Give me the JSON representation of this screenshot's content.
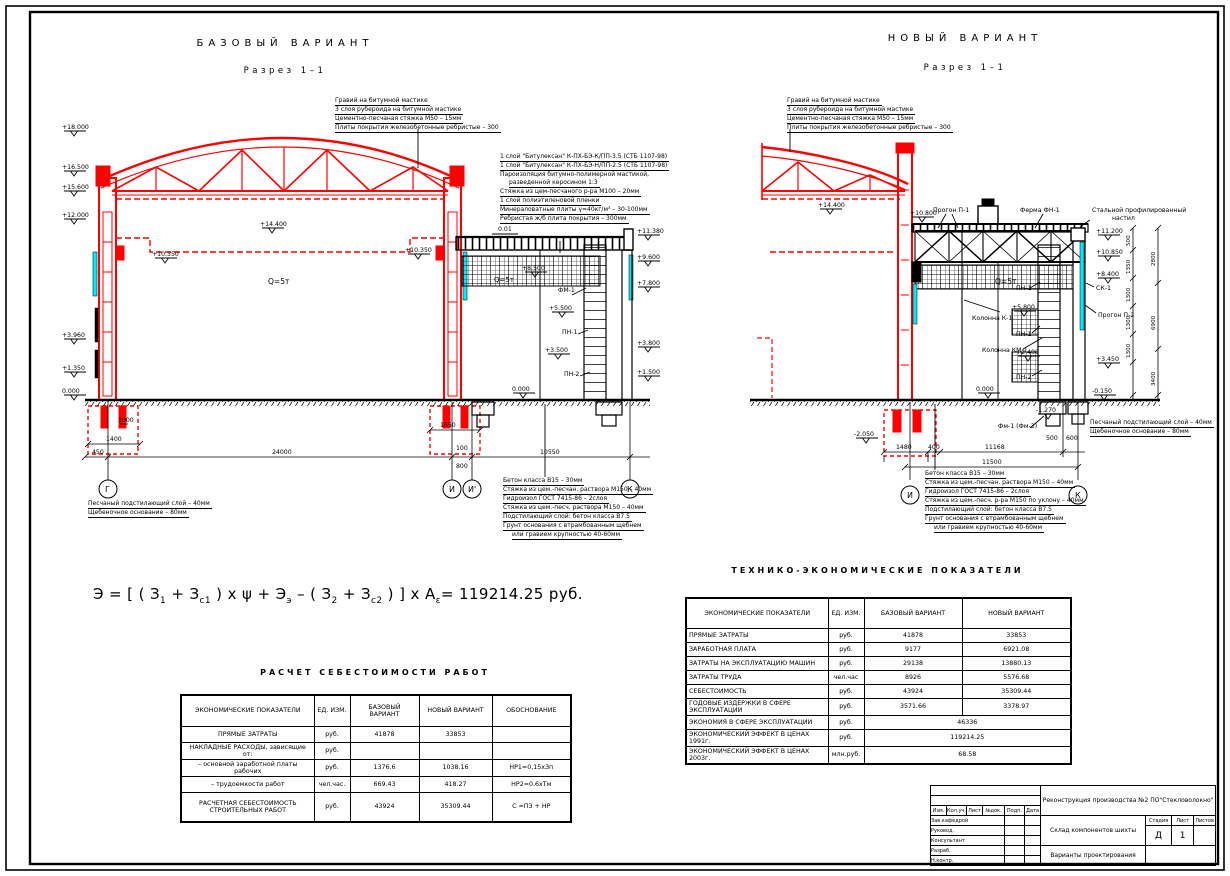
{
  "colors": {
    "red": "#ff0000",
    "black": "#000000",
    "cyan": "#00eaff"
  },
  "base_view": {
    "title": "БАЗОВЫЙ ВАРИАНТ",
    "subtitle": "Разрез 1–1",
    "roof_layers": [
      "Гравий на битумной мастике",
      "3 слоя рубероида на битумной мастике",
      "Цементно-песчаная стяжка М50 – 15мм",
      "Плиты покрытия железобетонные ребристые – 300"
    ],
    "annex_roof_layers": [
      "1 слой \"Битулексан\" К-ПХ-БЭ-К/ПП-3.5 (СТБ 1107-98)",
      "1 слой \"Битулексан\" К-ПХ-БЭ-Н/ПП-2.5 (СТБ 1107-98)",
      "Пароизоляция битумно-полимерной мастикой,",
      "разведенной керосином 1:3",
      "Стяжка из цем-песчаного р-ра М100 – 20мм",
      "1 слой полиэтиленовой пленки",
      "Минераловатные плиты γ=40кг/м³ – 30-100мм",
      "Ребристая ж/б плита покрытия – 300мм"
    ],
    "floor_layers": [
      "Бетон класса В15 – 30мм",
      "Стяжка из цем.-песчан. раствора М150 – 40мм",
      "Гидроизол ГОСТ 7415-86 – 2слоя",
      "Стяжка из цем.-песч. раствора М150 – 40мм",
      "Подстилающий слой: бетон класса В7.5",
      "Грунт основания с втрамбованным щебнем",
      "или гравием крупностью 40-60мм"
    ],
    "base_layers": [
      "Песчаный подстилающий слой – 40мм",
      "Щебеночное основание – 80мм"
    ],
    "crane_label": "Q=5т",
    "crane_label2": "Q=5т",
    "slope_label": "0.01",
    "panel_labels": {
      "fm1": "ФМ-1",
      "pn1": "ПН-1",
      "pn2": "ПН-2"
    },
    "elev_left": [
      "+18.000",
      "+16.500",
      "+15.600",
      "+12.000",
      "+3.960",
      "+1.350",
      "0.000"
    ],
    "elev_right": [
      "+11.380",
      "+9.600",
      "+7.800",
      "+3.800",
      "+1.500"
    ],
    "elev_inner": {
      "truss": "+14.400",
      "crane_l": "+10.350",
      "crane_r": "+10.350",
      "a1": "+8.500",
      "a2": "+5.500",
      "a3": "+3.500",
      "zero": "0.000"
    },
    "axes": [
      "Г",
      "И",
      "И'",
      "К"
    ],
    "dims": {
      "d450": "450",
      "d1400": "1400",
      "d1000": "1000",
      "d24000": "24000",
      "d1650": "1650",
      "d100": "100",
      "d800": "800",
      "d10550": "10550"
    }
  },
  "new_view": {
    "title": "НОВЫЙ ВАРИАНТ",
    "subtitle": "Разрез 1–1",
    "roof_layers": [
      "Гравий на битумной мастике",
      "3 слоя рубероида на битумной мастике",
      "Цементно-песчаная стяжка М50 – 15мм",
      "Плиты покрытия железобетонные ребристые – 300"
    ],
    "labels": {
      "progon1": "Прогон П-1",
      "ferma": "Ферма ФН-1",
      "nastil1": "Стальной профилированный",
      "nastil2": "настил",
      "kol_k1": "Колонна К-1",
      "kol_km1": "Колонна КМ-1",
      "pn1a": "ПН-1",
      "pn1b": "ПН-1",
      "pn2": "ПН-2",
      "sk1": "СК-1",
      "progon2": "Прогон П-2",
      "fm": "Фм-1 (Фм-3)"
    },
    "crane_label": "Q=5т",
    "elev": {
      "truss": "+14.400",
      "roof": "+10.800",
      "r1": "+11.200",
      "r2": "+10.850",
      "r3": "+8.400",
      "r4": "+3.450",
      "r5": "-0.150",
      "i1": "+5.800",
      "i2": "+2.400",
      "zero": "0.000",
      "f1": "-1.270",
      "f2": "-2.050"
    },
    "vdims_inner": [
      "500",
      "1350",
      "1300",
      "1300",
      "1300"
    ],
    "vdims_outer": [
      "2800",
      "6900",
      "3400"
    ],
    "dims": {
      "d1480": "1480",
      "d400": "400",
      "d11168": "11168",
      "d11500": "11500",
      "d500": "500",
      "d600": "600"
    },
    "axes": [
      "И",
      "К"
    ],
    "floor_layers": [
      "Бетон класса В15 – 30мм",
      "Стяжка из цем.-песчан. раствора М150 – 40мм",
      "Гидроизол ГОСТ 7415-86 – 2слоя",
      "Стяжка из цем.-песч. р-ра М150 по уклону – 40мм",
      "Подстилающий слой: бетон класса В7.5",
      "Грунт основания с втрамбованным щебнем",
      "или гравием крупностью 40-60мм"
    ],
    "base_layers": [
      "Песчаный подстилающий слой – 40мм",
      "Щебеночное основание – 80мм"
    ]
  },
  "formula": {
    "p1": "Э  =  [ (  З",
    "s1": "1",
    "p2": "  +   З",
    "s2": "с1",
    "p3": " ) x ψ  +   Э",
    "s3": "э",
    "p4": "   –  (  З",
    "s4": "2",
    "p5": "  +   З",
    "s5": "с2",
    "p6": " ) ]  x  А",
    "s6": "ε",
    "p7": "=  119214.25  руб."
  },
  "cost_table": {
    "title": "РАСЧЕТ СЕБЕСТОИМОСТИ РАБОТ",
    "headers": [
      "ЭКОНОМИЧЕСКИЕ ПОКАЗАТЕЛИ",
      "ЕД. ИЗМ.",
      "БАЗОВЫЙ ВАРИАНТ",
      "НОВЫЙ ВАРИАНТ",
      "ОБОСНОВАНИЕ"
    ],
    "rows": [
      {
        "name": "ПРЯМЫЕ ЗАТРАТЫ",
        "unit": "руб.",
        "base": "41878",
        "new": "33853",
        "just": ""
      },
      {
        "name": "НАКЛАДНЫЕ РАСХОДЫ, зависящие от:",
        "unit": "руб.",
        "base": "",
        "new": "",
        "just": ""
      },
      {
        "name": "– основной заработной платы рабочих",
        "unit": "руб.",
        "base": "1376.6",
        "new": "1038.16",
        "just": "НР1=0,15хЗп"
      },
      {
        "name": "– трудоемкости работ",
        "unit": "чел.час.",
        "base": "669.43",
        "new": "418.27",
        "just": "НР2=0.6хТм"
      },
      {
        "name": "РАСЧЕТНАЯ СЕБЕСТОИМОСТЬ СТРОИТЕЛЬНЫХ РАБОТ",
        "unit": "руб.",
        "base": "43924",
        "new": "35309.44",
        "just": "С =ПЗ + НР"
      }
    ]
  },
  "tep_table": {
    "title": "ТЕХНИКО-ЭКОНОМИЧЕСКИЕ ПОКАЗАТЕЛИ",
    "headers": [
      "ЭКОНОМИЧЕСКИЕ ПОКАЗАТЕЛИ",
      "ЕД. ИЗМ.",
      "БАЗОВЫЙ ВАРИАНТ",
      "НОВЫЙ ВАРИАНТ"
    ],
    "rows": [
      {
        "name": "ПРЯМЫЕ ЗАТРАТЫ",
        "unit": "руб.",
        "base": "41878",
        "new": "33853"
      },
      {
        "name": "ЗАРАБОТНАЯ ПЛАТА",
        "unit": "руб.",
        "base": "9177",
        "new": "6921.08"
      },
      {
        "name": "ЗАТРАТЫ НА ЭКСПЛУАТАЦИЮ МАШИН",
        "unit": "руб.",
        "base": "29138",
        "new": "13880.13"
      },
      {
        "name": "ЗАТРАТЫ ТРУДА",
        "unit": "чел.час",
        "base": "8926",
        "new": "5576.68"
      },
      {
        "name": "СЕБЕСТОИМОСТЬ",
        "unit": "руб.",
        "base": "43924",
        "new": "35309.44"
      },
      {
        "name": "ГОДОВЫЕ ИЗДЕРЖКИ В СФЕРЕ ЭКСПЛУАТАЦИИ",
        "unit": "руб.",
        "base": "3571.66",
        "new": "3378.97"
      }
    ],
    "span_rows": [
      {
        "name": "ЭКОНОМИЯ В СФЕРЕ ЭКСПЛУАТАЦИИ",
        "unit": "руб.",
        "value": "46336"
      },
      {
        "name": "ЭКОНОМИЧЕСКИЙ ЭФФЕКТ В ЦЕНАХ 1991г.",
        "unit": "руб.",
        "value": "119214.25"
      },
      {
        "name": "ЭКОНОМИЧЕСКИЙ ЭФФЕКТ В ЦЕНАХ 2003г.",
        "unit": "млн.руб.",
        "value": "68.58"
      }
    ]
  },
  "stamp": {
    "project": "Реконструкция производства №2 ПО\"Стекловолокно\"",
    "object": "Склад компонентов шихты",
    "doc": "Варианты проектирования",
    "stage_label": "Стадия",
    "sheet_label": "Лист",
    "sheets_label": "Листов",
    "stage": "Д",
    "sheet": "1",
    "sig_header": [
      "Изм.",
      "Кол.уч.",
      "Лист",
      "№док.",
      "Подп.",
      "Дата"
    ],
    "sig_rows": [
      "Зав.кафедрой",
      "Руковод.",
      "Консультант",
      "Разраб.",
      "Н.контр."
    ]
  }
}
